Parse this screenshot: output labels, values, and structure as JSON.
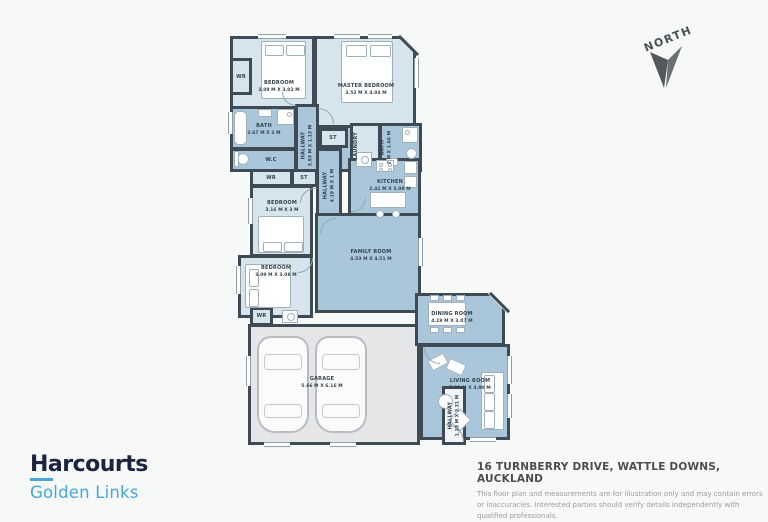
{
  "compass": {
    "label": "NORTH"
  },
  "floorplan": {
    "rooms": {
      "bedroom1": {
        "label": "BEDROOM",
        "dims": "3.09 M X 3.02 M"
      },
      "master": {
        "label": "MASTER BEDROOM",
        "dims": "3.52 M X 4.04 M"
      },
      "bath": {
        "label": "BATH",
        "dims": "2.67 M X 2 M"
      },
      "wc": {
        "label": "W.C"
      },
      "wr": {
        "label": "WR"
      },
      "st": {
        "label": "ST"
      },
      "laundry": {
        "label": "LAUNDRY"
      },
      "ensuite": {
        "label": "BATH",
        "dims": "2 M X 1.66 M"
      },
      "hallway_upper": {
        "label": "HALLWAY",
        "dims": "3.93 M X 1.13 M"
      },
      "hallway_mid": {
        "label": "HALLWAY",
        "dims": "4.19 M X 1 M"
      },
      "hallway_entry": {
        "label": "HALLWAY",
        "dims": "1.23 M X 3.31 M"
      },
      "bedroom2": {
        "label": "BEDROOM",
        "dims": "3.16 M X 3 M"
      },
      "bedroom3": {
        "label": "BEDROOM",
        "dims": "3.09 M X 3.08 M"
      },
      "kitchen": {
        "label": "KITCHEN",
        "dims": "2.41 M X 3.08 M"
      },
      "family": {
        "label": "FAMILY ROOM",
        "dims": "4.53 M X 4.51 M"
      },
      "garage": {
        "label": "GARAGE",
        "dims": "5.66 M X 6.16 M"
      },
      "dining": {
        "label": "DINING ROOM",
        "dims": "4.19 M X 3.07 M"
      },
      "living": {
        "label": "LIVING ROOM",
        "dims": "5.32 M X 4.90 M"
      }
    }
  },
  "footer": {
    "brand": "Harcourts",
    "office": "Golden Links",
    "address": "16 TURNBERRY DRIVE, WATTLE DOWNS, AUCKLAND",
    "disclaimer": "This floor plan and measurements are for illustration only and may contain errors or inaccuracies. Interested parties should verify details independently with qualified professionals."
  },
  "colors": {
    "wall": "#3e4b55",
    "room_light": "#d6e4ee",
    "room_medium": "#a9c6db",
    "garage_fill": "#e4e6e8",
    "brand_navy": "#1c2440",
    "brand_blue": "#45a7e0"
  }
}
